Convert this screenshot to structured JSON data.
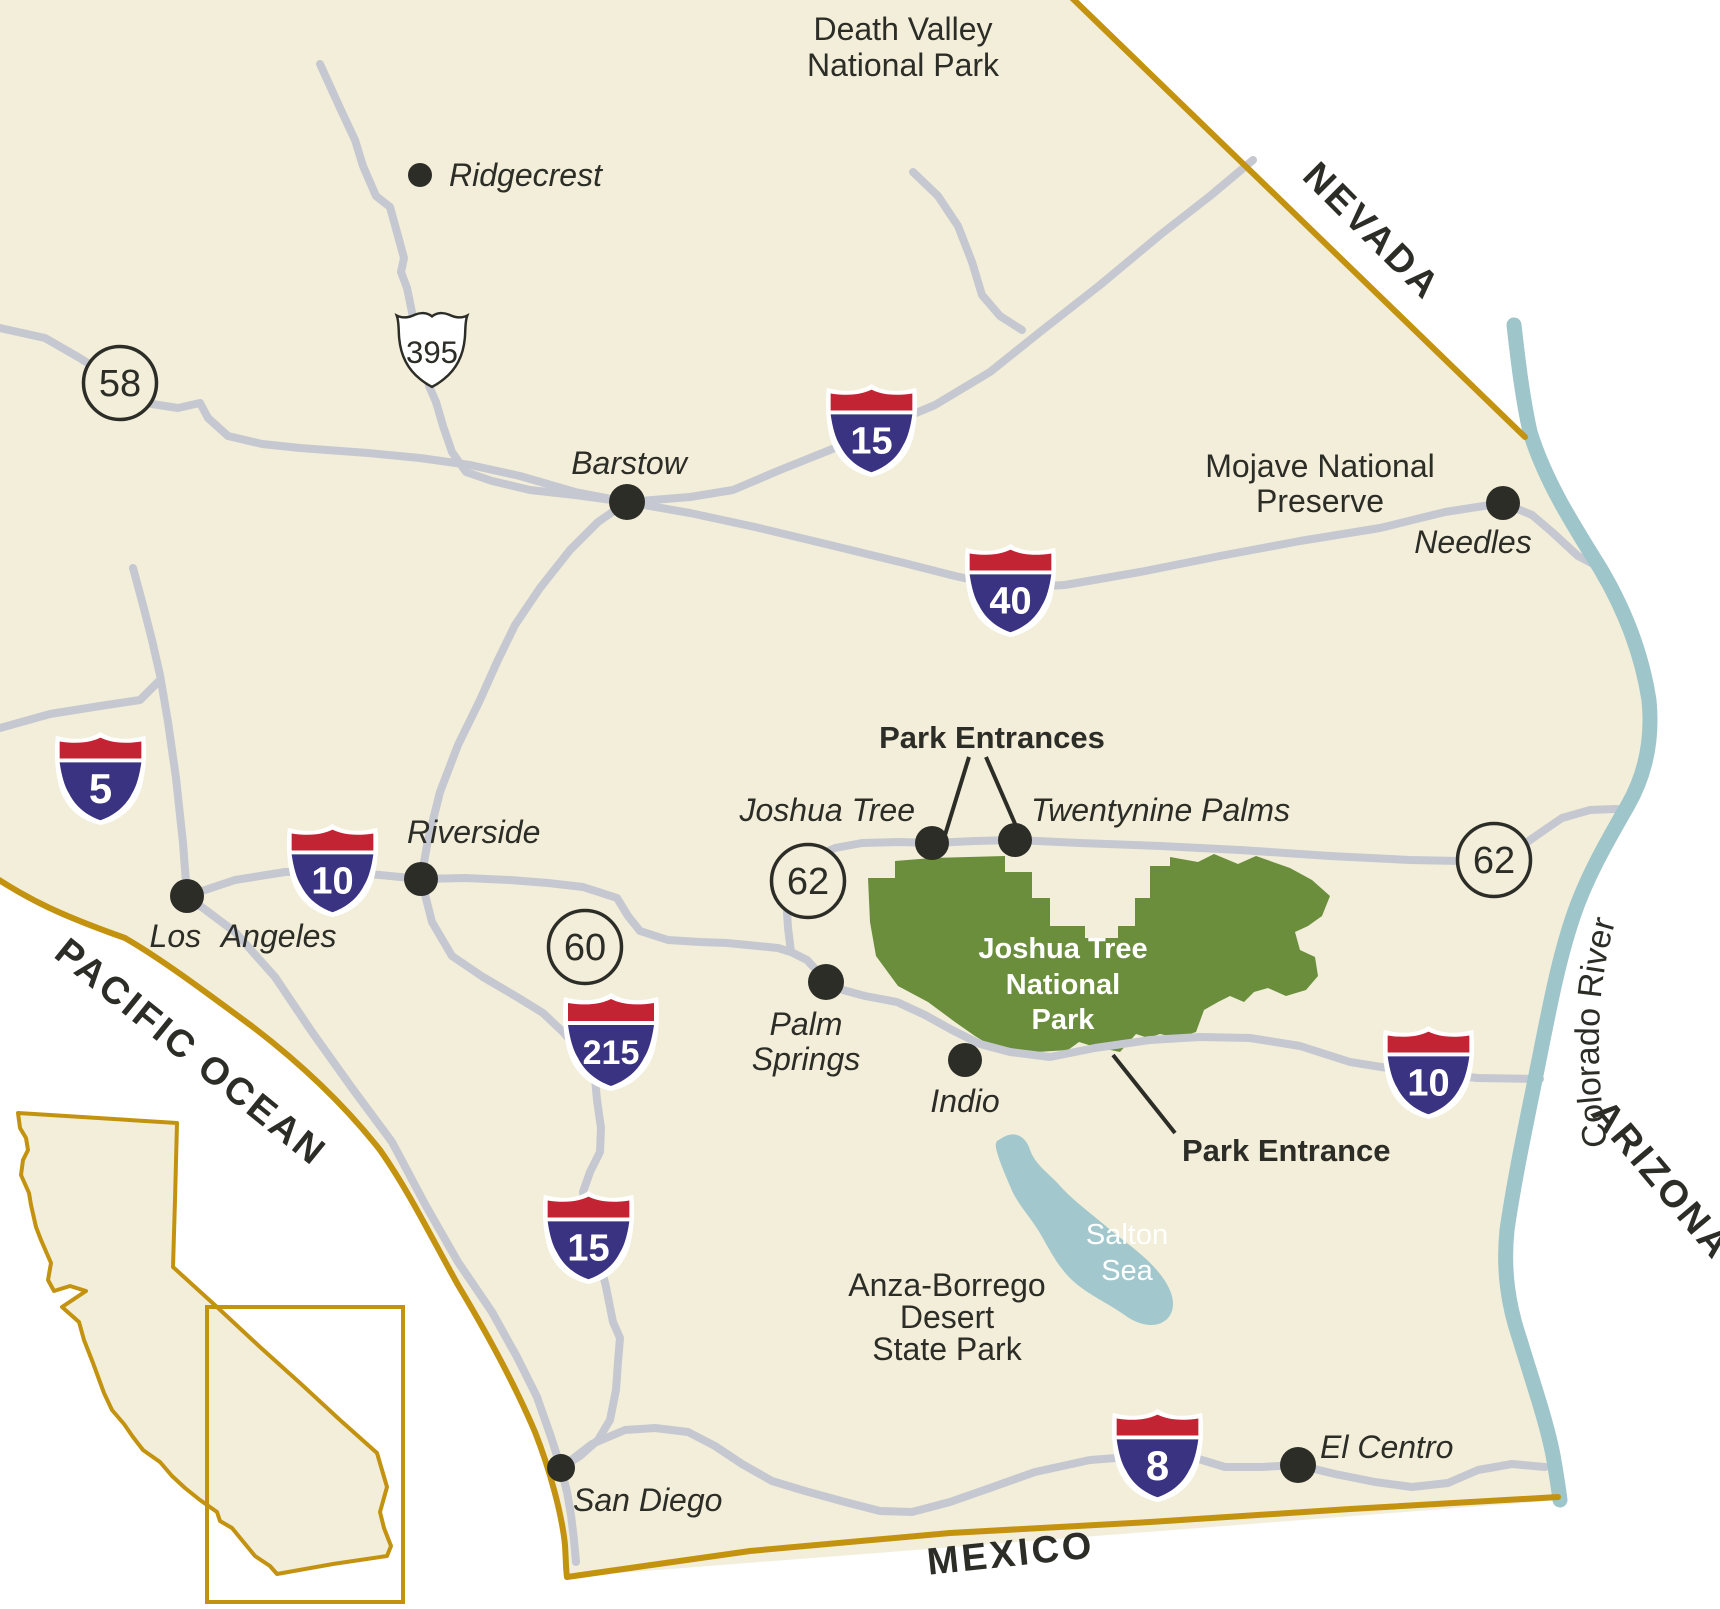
{
  "regions": {
    "nevada": "NEVADA",
    "arizona": "ARIZONA",
    "mexico": "MEXICO",
    "pacific_ocean": "PACIFIC OCEAN"
  },
  "water": {
    "colorado_river": "Colorado River",
    "salton_sea_line1": "Salton",
    "salton_sea_line2": "Sea"
  },
  "parks": {
    "death_valley_line1": "Death Valley",
    "death_valley_line2": "National Park",
    "mojave_line1": "Mojave National",
    "mojave_line2": "Preserve",
    "joshua_tree_line1": "Joshua Tree",
    "joshua_tree_line2": "National",
    "joshua_tree_line3": "Park",
    "anza_borrego_line1": "Anza-Borrego",
    "anza_borrego_line2": "Desert",
    "anza_borrego_line3": "State Park"
  },
  "annotations": {
    "park_entrances": "Park Entrances",
    "park_entrance": "Park Entrance"
  },
  "cities": {
    "ridgecrest": "Ridgecrest",
    "barstow": "Barstow",
    "needles": "Needles",
    "los_angeles": "Los Angeles",
    "riverside": "Riverside",
    "palm_springs_line1": "Palm",
    "palm_springs_line2": "Springs",
    "indio": "Indio",
    "joshua_tree": "Joshua Tree",
    "twentynine_palms": "Twentynine Palms",
    "san_diego": "San Diego",
    "el_centro": "El Centro"
  },
  "route_shields": {
    "interstate_5": "5",
    "interstate_8": "8",
    "interstate_10": "10",
    "interstate_15": "15",
    "interstate_40": "40",
    "interstate_215": "215",
    "us_395": "395",
    "state_58": "58",
    "state_60": "60",
    "state_62": "62"
  },
  "colors": {
    "land": "#f2eed9",
    "state_border_gold": "#c3920f",
    "road_gray": "#c5c8d0",
    "river_blue": "#9dc5ca",
    "park_green": "#6b8e3d",
    "salton_sea_blue": "#a2c8cd",
    "shield_red": "#c32433",
    "shield_blue": "#3a3382",
    "marker_ink": "#2d2d28"
  }
}
